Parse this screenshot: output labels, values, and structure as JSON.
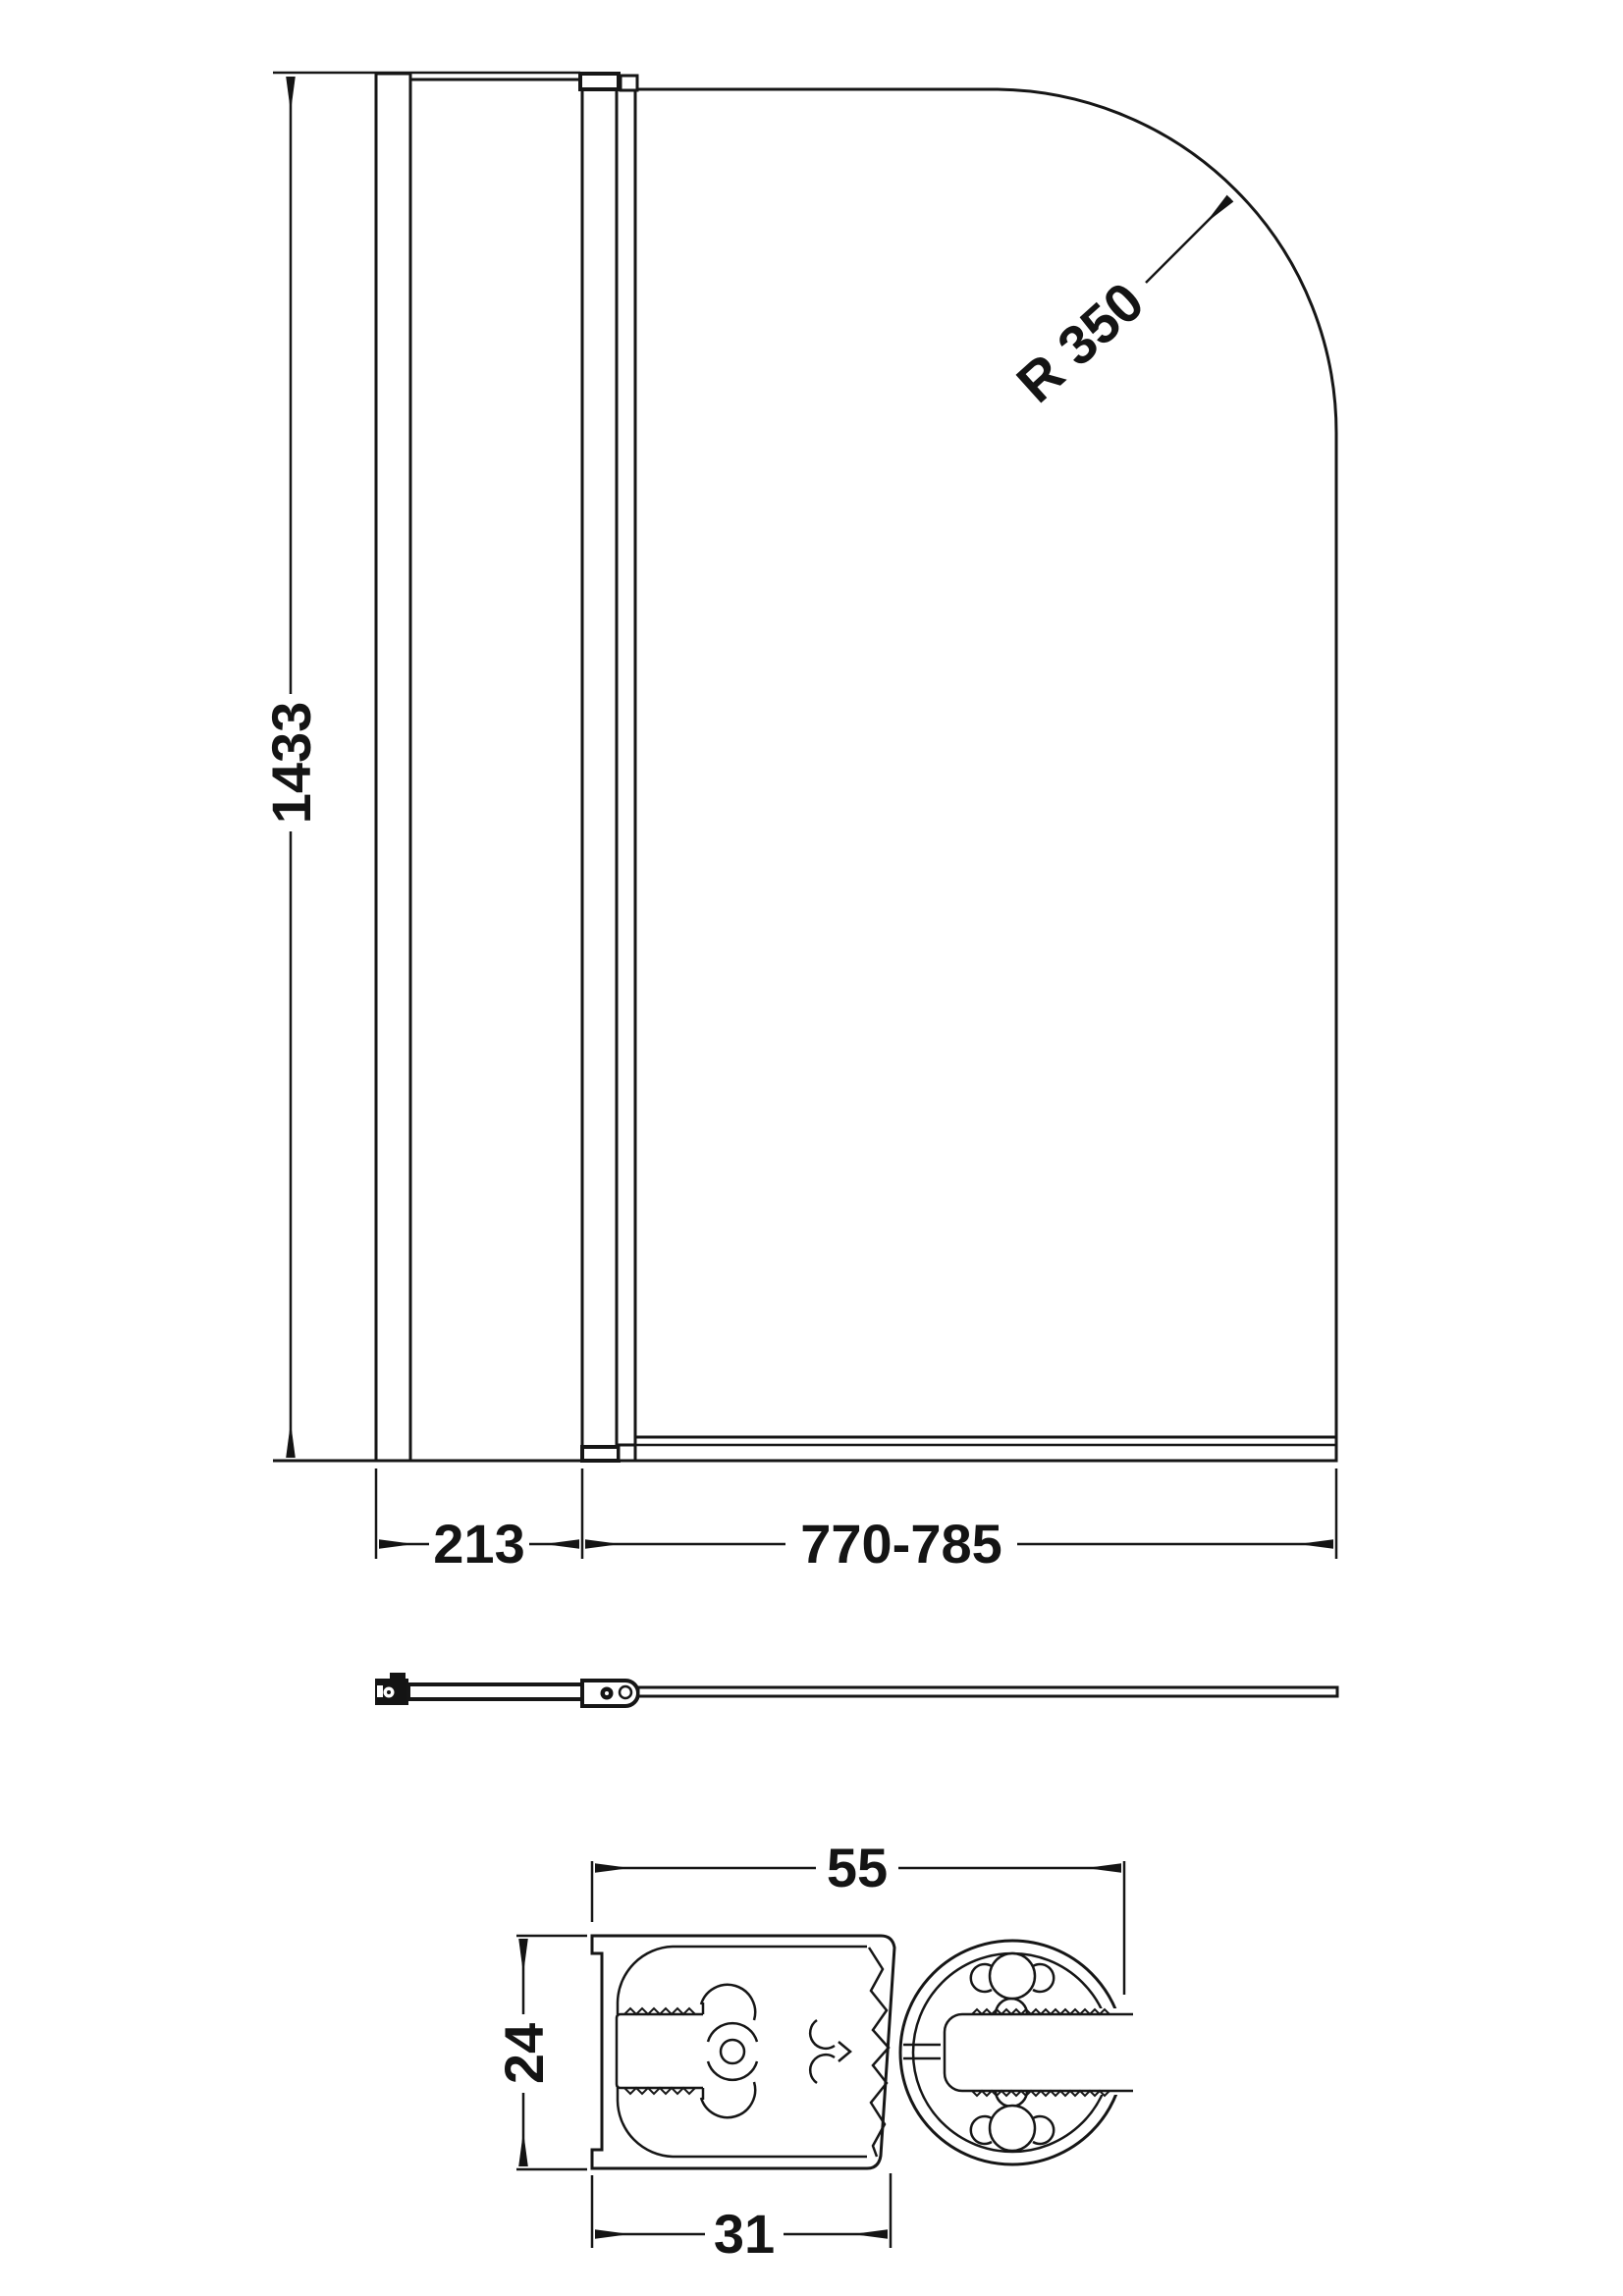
{
  "drawing": {
    "description": "Hinged bath shower screen technical drawing with front elevation, plan view and extrusion profile section",
    "line_color": "#161616",
    "background_color": "#ffffff",
    "dimensions": {
      "overall_height": "1433",
      "fixed_panel_width": "213",
      "door_panel_width": "770-785",
      "top_corner_radius": "R 350",
      "profile_overall_width": "55",
      "profile_height": "24",
      "profile_body_width": "31"
    }
  }
}
